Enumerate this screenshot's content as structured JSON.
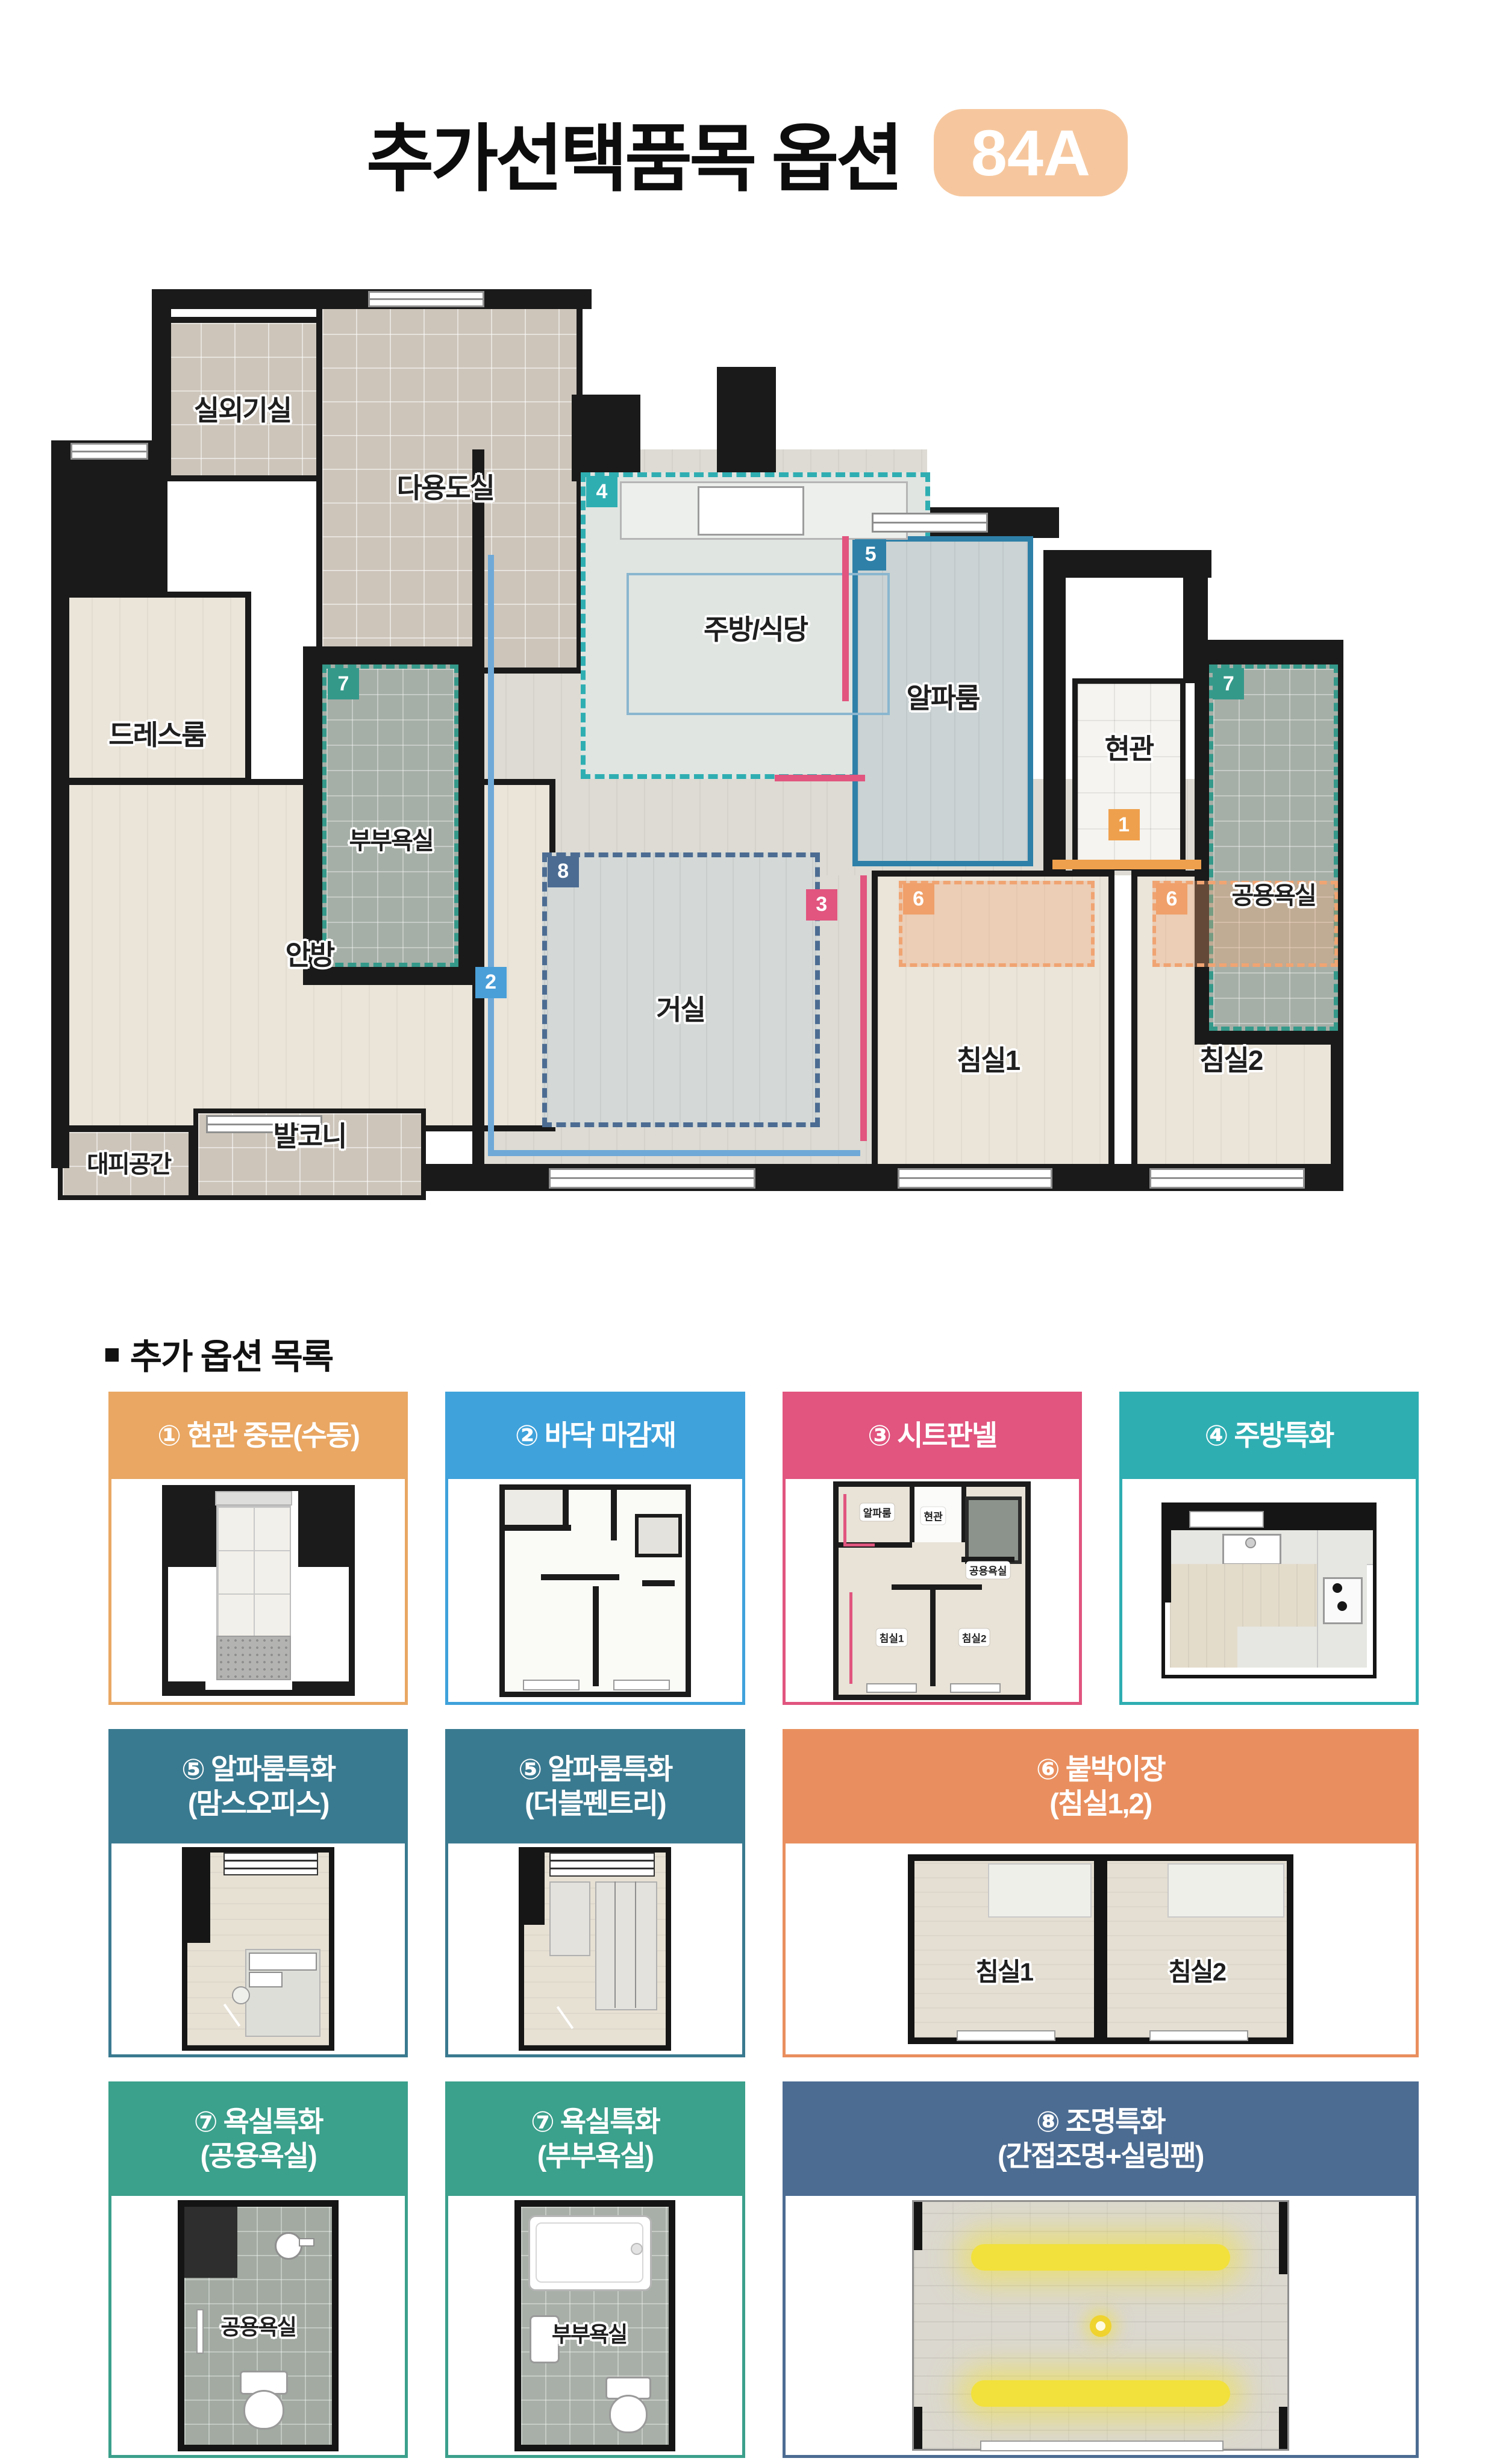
{
  "page": {
    "title": "추가선택품목 옵션",
    "badge": "84A",
    "section_marker": "■",
    "section_title": "추가 옵션 목록"
  },
  "colors": {
    "badge_bg": "#F6C79E",
    "wall": "#1a1a1a",
    "opt1": "#E9A763",
    "opt2": "#3FA2DB",
    "opt3": "#E1557F",
    "opt4": "#2FAEB2",
    "opt5_header": "#3A7A90",
    "opt5_line": "#2E80A8",
    "opt6": "#E98F5F",
    "opt7": "#3BA08C",
    "opt8": "#4C6C92",
    "floor_line_blue": "#6FA9D8",
    "light_yellow": "#F2E13C"
  },
  "floor_plan": {
    "rooms": [
      {
        "label": "실외기실"
      },
      {
        "label": "다용도실"
      },
      {
        "label": "드레스룸"
      },
      {
        "label": "부부욕실"
      },
      {
        "label": "주방/식당"
      },
      {
        "label": "알파룸"
      },
      {
        "label": "현관"
      },
      {
        "label": "공용욕실"
      },
      {
        "label": "안방"
      },
      {
        "label": "거실"
      },
      {
        "label": "침실1"
      },
      {
        "label": "침실2"
      },
      {
        "label": "대피공간"
      },
      {
        "label": "발코니"
      }
    ],
    "markers": {
      "door": "1",
      "floor": "2",
      "sheet": "3",
      "kitchen": "4",
      "alpha": "5",
      "closet": "6",
      "bath": "7",
      "light": "8"
    }
  },
  "options": [
    {
      "no": "①",
      "label": "현관 중문(수동)",
      "color": "#E9A763"
    },
    {
      "no": "②",
      "label": "바닥 마감재",
      "color": "#3FA2DB"
    },
    {
      "no": "③",
      "label": "시트판넬",
      "color": "#E1557F",
      "mini_labels": [
        "알파룸",
        "현관",
        "공용욕실",
        "침실1",
        "침실2"
      ]
    },
    {
      "no": "④",
      "label": "주방특화",
      "color": "#2FAEB2"
    },
    {
      "no": "⑤",
      "label": "알파룸특화",
      "sublabel": "(맘스오피스)",
      "color": "#3A7A90"
    },
    {
      "no": "⑤",
      "label": "알파룸특화",
      "sublabel": "(더블펜트리)",
      "color": "#3A7A90"
    },
    {
      "no": "⑥",
      "label": "붙박이장",
      "sublabel": "(침실1,2)",
      "color": "#E98F5F",
      "room_labels": [
        "침실1",
        "침실2"
      ]
    },
    {
      "no": "⑦",
      "label": "욕실특화",
      "sublabel": "(공용욕실)",
      "color": "#3BA08C",
      "thumb_label": "공용욕실"
    },
    {
      "no": "⑦",
      "label": "욕실특화",
      "sublabel": "(부부욕실)",
      "color": "#3BA08C",
      "thumb_label": "부부욕실"
    },
    {
      "no": "⑧",
      "label": "조명특화",
      "sublabel": "(간접조명+실링팬)",
      "color": "#4C6C92"
    }
  ]
}
